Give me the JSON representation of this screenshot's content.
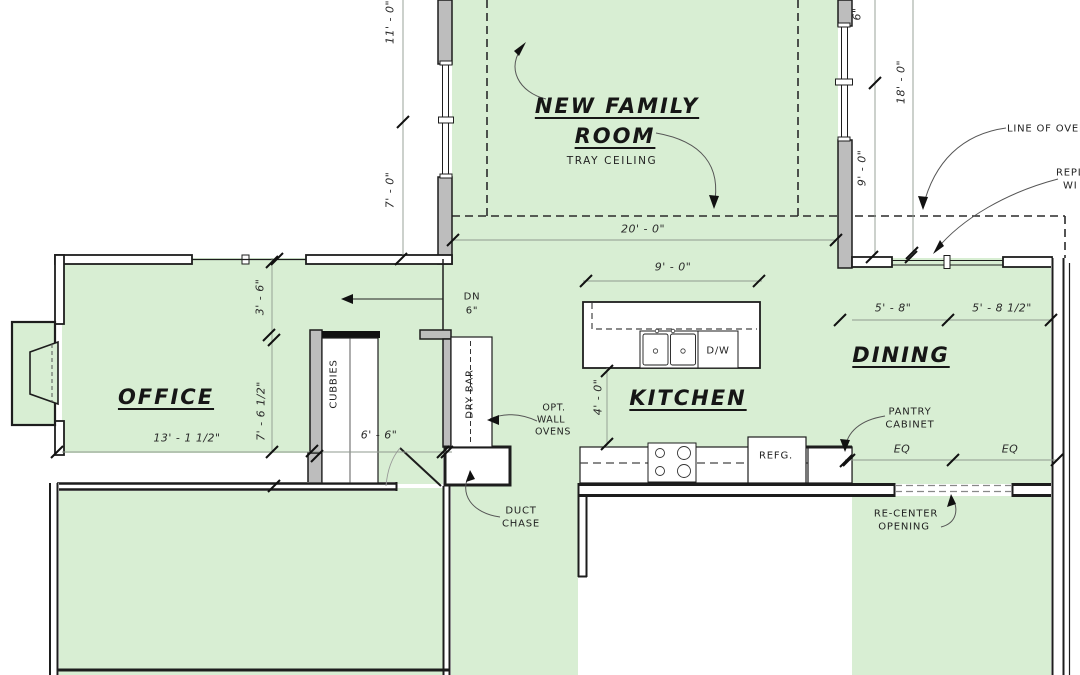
{
  "plan": {
    "rooms": {
      "family_room": {
        "name_line1": "NEW FAMILY",
        "name_line2": "ROOM",
        "ceiling_note": "TRAY CEILING"
      },
      "office": {
        "name": "OFFICE"
      },
      "kitchen": {
        "name": "KITCHEN"
      },
      "dining": {
        "name": "DINING"
      }
    },
    "fixtures": {
      "cubbies": "CUBBIES",
      "dry_bar": "DRY BAR",
      "dishwasher": "D/W",
      "refrigerator": "REFG.",
      "duct_chase": {
        "line1": "DUCT",
        "line2": "CHASE"
      },
      "wall_ovens": {
        "line1": "OPT.",
        "line2": "WALL",
        "line3": "OVENS"
      },
      "pantry": {
        "line1": "PANTRY",
        "line2": "CABINET"
      }
    },
    "annotations": {
      "down": {
        "label": "DN",
        "size": "6\""
      },
      "recenter": {
        "line1": "RE-CENTER",
        "line2": "OPENING"
      },
      "overhang": "LINE OF OVER",
      "replace": {
        "line1": "REPL",
        "line2": "WI"
      }
    },
    "dimensions": {
      "family_width": "20' - 0\"",
      "island_width": "9' - 0\"",
      "island_depth": "4' - 0\"",
      "left_upper": "11' - 0\"",
      "left_lower": "7' - 0\"",
      "right_top_partial": "6\"",
      "right_side": "18' - 0\"",
      "right_lower": "9' - 0\"",
      "office_width": "13' - 1 1/2\"",
      "office_upper": "3' - 6\"",
      "office_lower": "7' - 6 1/2\"",
      "mud_width": "6' - 6\"",
      "dining_left": "5' - 8\"",
      "dining_right": "5' - 8 1/2\"",
      "eq_left": "EQ",
      "eq_right": "EQ"
    },
    "colors": {
      "room_fill": "#d8eed3",
      "wall_fill": "#bdbdbd",
      "line": "#1d1d1d",
      "dim_line": "#8f998f"
    }
  }
}
